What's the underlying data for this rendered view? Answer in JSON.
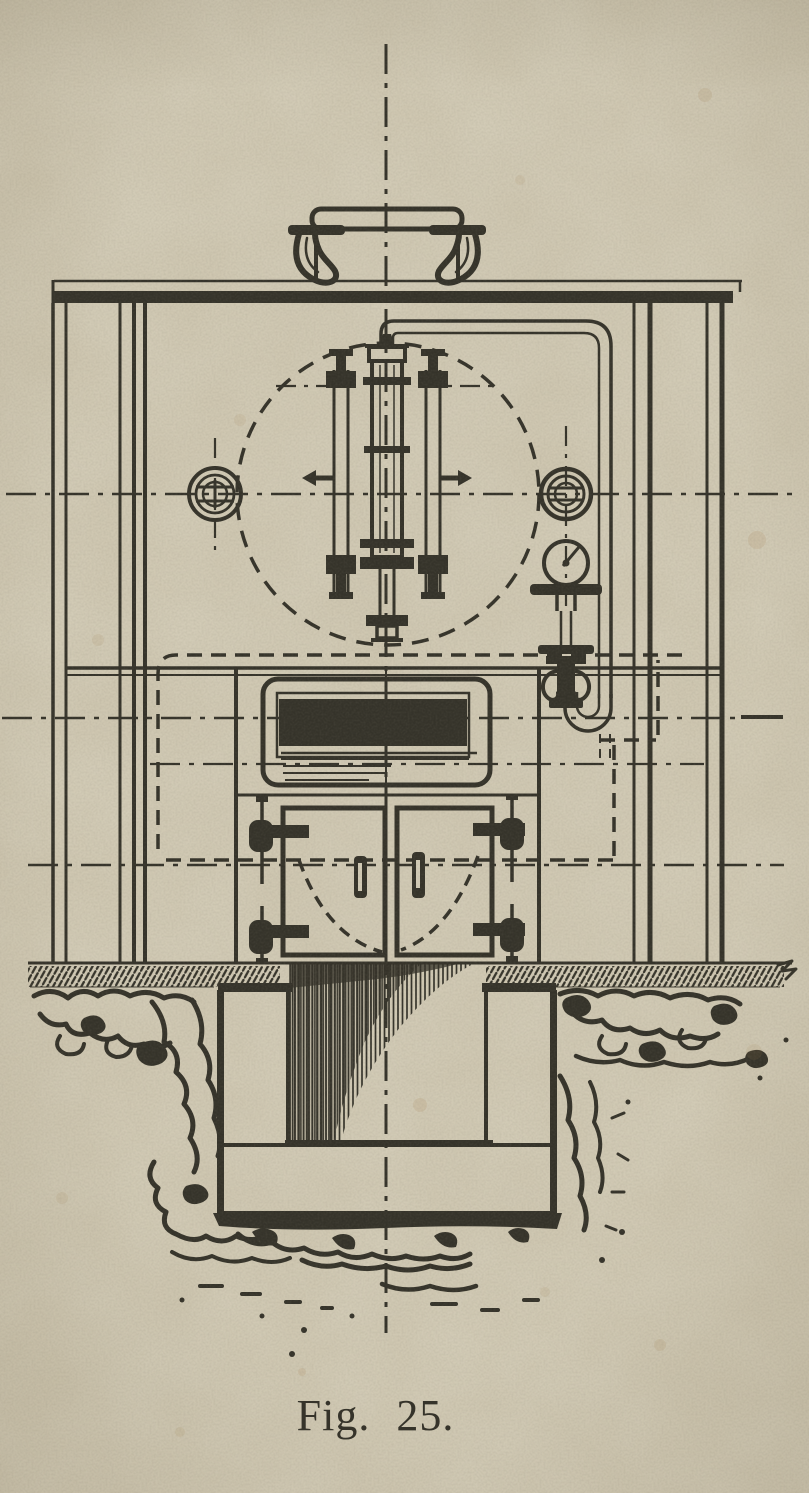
{
  "figure": {
    "caption": "Fig. 25."
  },
  "colors": {
    "paper": "#d2cbb6",
    "ink": "#35332a",
    "stain": "#a5814f"
  },
  "drawing": {
    "type": "engraved technical drawing, front elevation with below-ground section",
    "parts": [
      "vertical-centerline",
      "steam-dome-manhole",
      "top-plate",
      "frame-columns",
      "boiler-shell-dashed-circle",
      "safety-valve-assembly",
      "left-washout-plug",
      "right-washout-plug",
      "pressure-gauge",
      "gauge-shutoff-valve",
      "escape-pipe-with-siphon",
      "brick-setting-dashed-outline",
      "fire-hole",
      "fire-doors",
      "ground-line",
      "foundation-masonry",
      "ash-pit",
      "excavated-earth"
    ]
  }
}
